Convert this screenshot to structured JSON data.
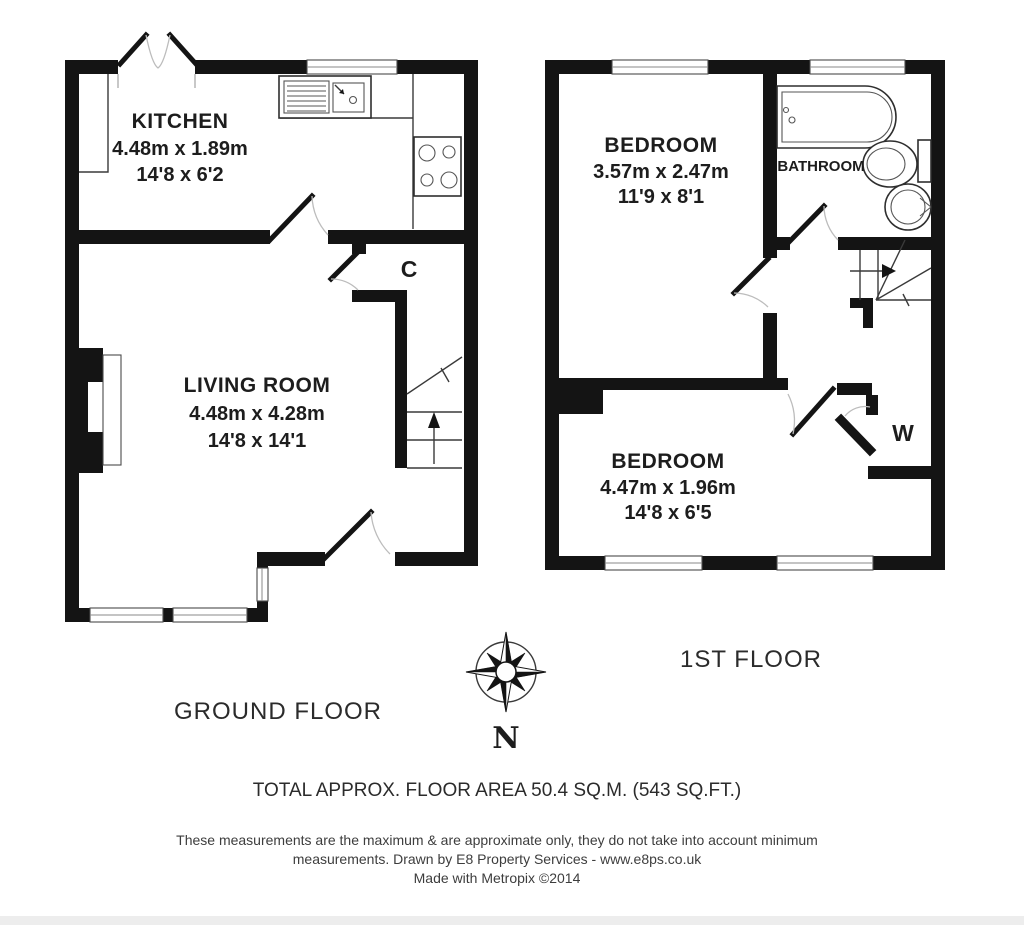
{
  "ground_floor": {
    "label": "GROUND FLOOR",
    "rooms": {
      "kitchen": {
        "name": "KITCHEN",
        "dimensions_metric": "4.48m x 1.89m",
        "dimensions_imperial": "14'8 x 6'2"
      },
      "living_room": {
        "name": "LIVING ROOM",
        "dimensions_metric": "4.48m x 4.28m",
        "dimensions_imperial": "14'8 x 14'1"
      },
      "cupboard": {
        "abbreviation": "C"
      }
    }
  },
  "first_floor": {
    "label": "1ST FLOOR",
    "rooms": {
      "bedroom_front": {
        "name": "BEDROOM",
        "dimensions_metric": "3.57m x 2.47m",
        "dimensions_imperial": "11'9 x 8'1"
      },
      "bedroom_back": {
        "name": "BEDROOM",
        "dimensions_metric": "4.47m x 1.96m",
        "dimensions_imperial": "14'8 x 6'5"
      },
      "bathroom": {
        "name": "BATHROOM"
      },
      "wardrobe": {
        "abbreviation": "W"
      }
    }
  },
  "compass": {
    "north_label": "N"
  },
  "footer": {
    "total_area": "TOTAL APPROX. FLOOR AREA 50.4 SQ.M. (543 SQ.FT.)",
    "disclaimer_line1": "These measurements are the maximum & are approximate only, they do not take into account minimum",
    "disclaimer_line2": "measurements. Drawn by E8 Property Services - www.e8ps.co.uk",
    "credit": "Made with Metropix ©2014"
  },
  "colors": {
    "wall": "#141414",
    "text": "#1d1d1d",
    "background": "#ffffff"
  }
}
